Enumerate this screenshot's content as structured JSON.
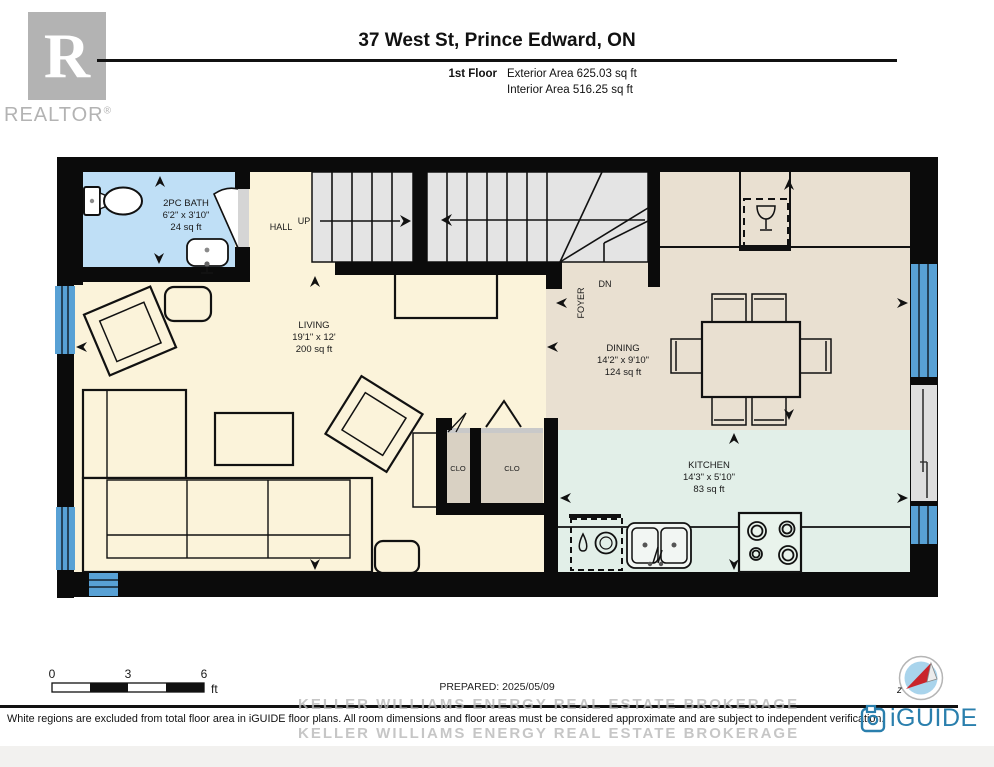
{
  "header": {
    "realtor_r": "R",
    "realtor_text": "REALTOR",
    "realtor_reg": "®",
    "title": "37 West St, Prince Edward, ON",
    "floor_label": "1st Floor",
    "exterior_area": "Exterior Area 625.03 sq ft",
    "interior_area": "Interior Area 516.25 sq ft"
  },
  "plan": {
    "rooms": {
      "bath": {
        "name": "2PC BATH",
        "dims": "6'2\" x 3'10\"",
        "area": "24 sq ft"
      },
      "hall": {
        "name": "HALL"
      },
      "living": {
        "name": "LIVING",
        "dims": "19'1\" x 12'",
        "area": "200 sq ft"
      },
      "foyer": {
        "name": "FOYER"
      },
      "dining": {
        "name": "DINING",
        "dims": "14'2\" x 9'10\"",
        "area": "124 sq ft"
      },
      "kitchen": {
        "name": "KITCHEN",
        "dims": "14'3\" x 5'10\"",
        "area": "83 sq ft"
      },
      "clo_left": {
        "name": "CLO"
      },
      "clo_right": {
        "name": "CLO"
      }
    },
    "stairs": {
      "up": "UP",
      "dn": "DN"
    }
  },
  "scalebar": {
    "t0": "0",
    "t3": "3",
    "t6": "6",
    "unit": "ft"
  },
  "footer": {
    "prepared": "PREPARED: 2025/05/09",
    "watermark_top": "KELLER WILLIAMS ENERGY REAL ESTATE  BROKERAGE",
    "watermark_bottom": "KELLER WILLIAMS ENERGY REAL ESTATE  BROKERAGE",
    "disclaimer": "White regions are excluded from total floor area in iGUIDE floor plans. All room dimensions and floor areas must be considered approximate and are subject to independent verification.",
    "brand": "iGUIDE",
    "north_label": "z"
  },
  "colors": {
    "wall": "#0b0b0b",
    "bath_fill": "#bfdff6",
    "living_fill": "#fbf3da",
    "dining_fill": "#e9e0d1",
    "kitchen_fill": "#e2efe8",
    "closet_fill": "#d9d1c3",
    "stair_fill": "#e4e4e4",
    "window_blue": "#58a1d5",
    "door_gray": "#d5d5d5",
    "iguide_teal": "#2a7fad",
    "compass_red": "#c9242b",
    "watermark_gray": "#b9b9b9",
    "logo_gray": "#b3b3b3"
  }
}
